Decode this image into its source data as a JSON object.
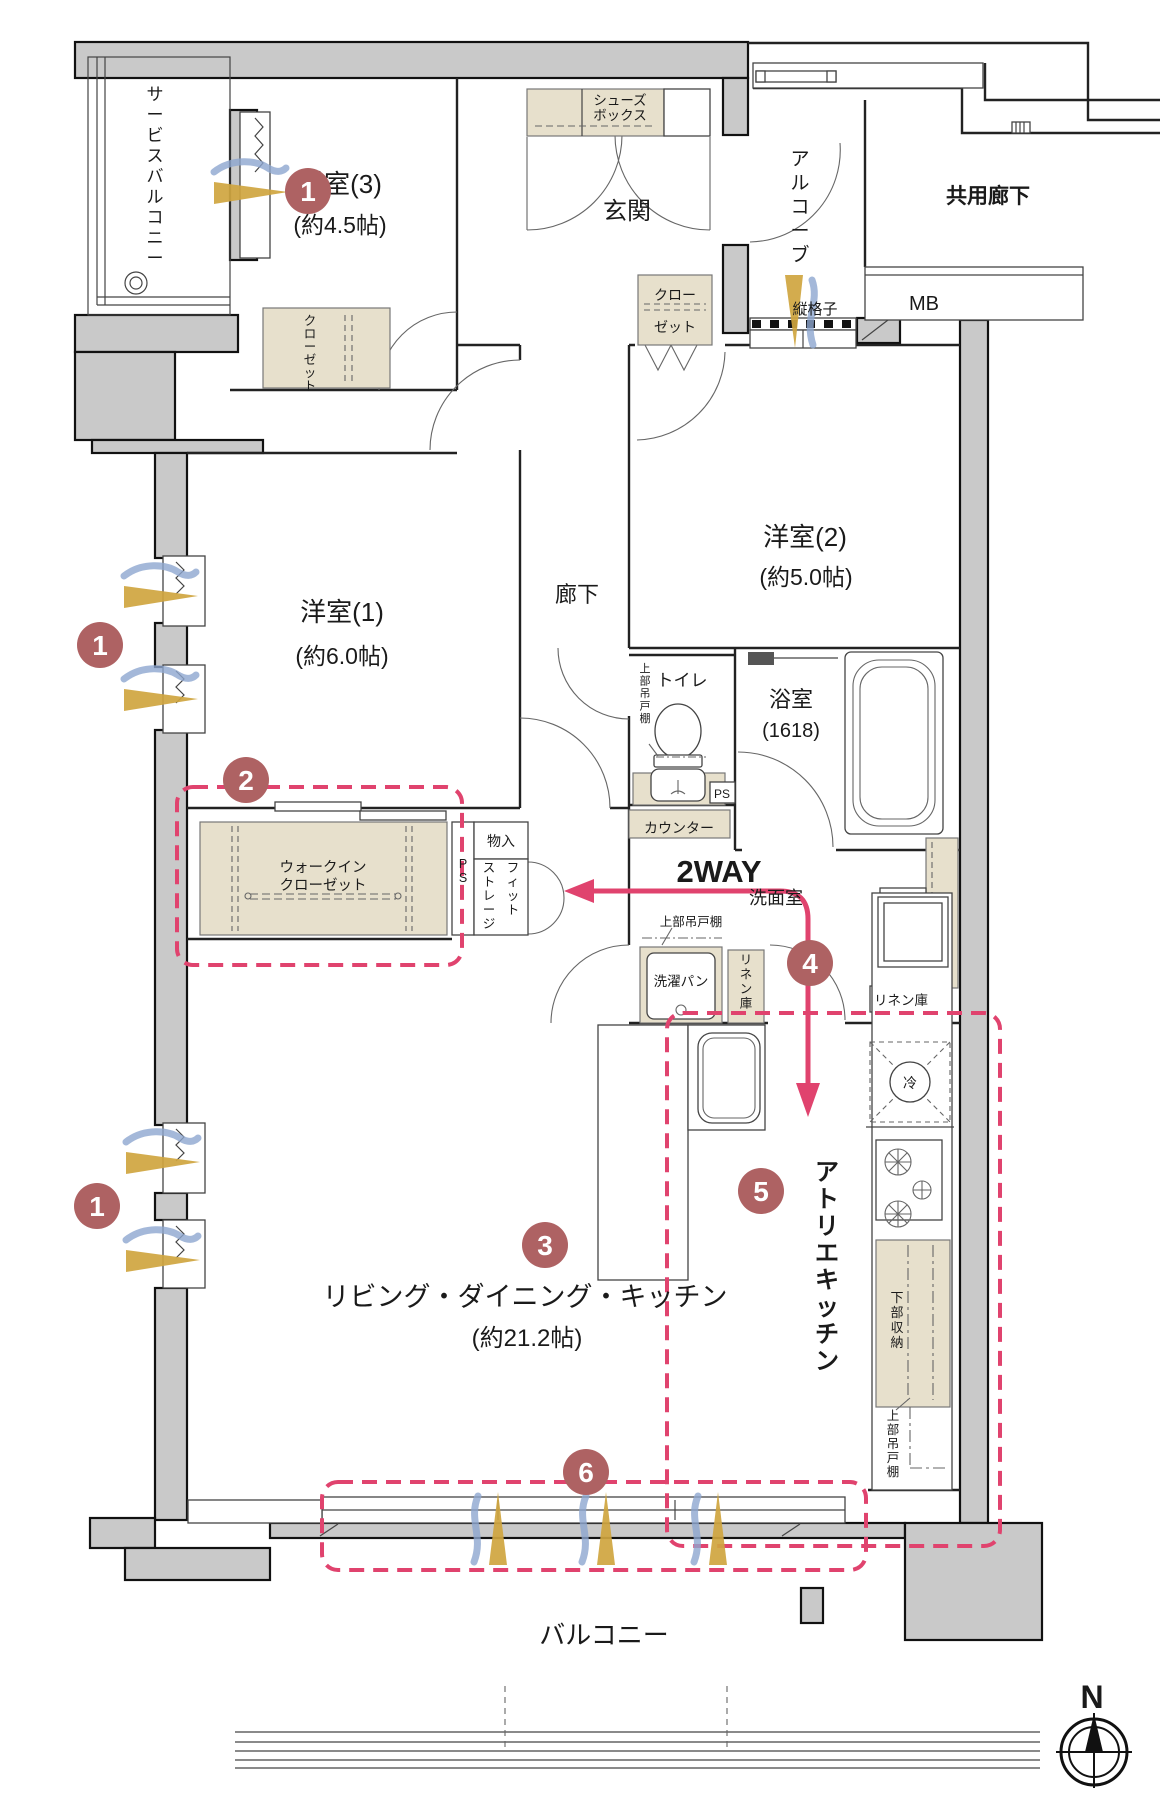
{
  "colors": {
    "accent_pink": "#e0436e",
    "marker_rose": "#ae6263",
    "wall_gray": "#c9c9c9",
    "storage_beige": "#e7e0cc",
    "air_blue": "#8da6cf",
    "air_gold": "#cfa53f"
  },
  "labels": {
    "service_balcony": "サービスバルコニー",
    "yoshitsu3": [
      "洋室(3)",
      "(約4.5帖)"
    ],
    "yoshitsu2": [
      "洋室(2)",
      "(約5.0帖)"
    ],
    "yoshitsu1": [
      "洋室(1)",
      "(約6.0帖)"
    ],
    "genkan": "玄関",
    "shoe_box": [
      "シューズ",
      "ボックス"
    ],
    "alcove": "アルコーブ",
    "tategoshi": "縦格子",
    "kyoyo_roka": "共用廊下",
    "mb": "MB",
    "closet_y3": "クローゼット",
    "closet_genkan": [
      "クロー",
      "ゼット"
    ],
    "roka": "廊下",
    "toilet": "トイレ",
    "toilet_upper_shelf": "上部吊戸棚",
    "bath": [
      "浴室",
      "(1618)"
    ],
    "counter": "カウンター",
    "ps_toilet": "PS",
    "ps_shaft": "PS",
    "wic": [
      "ウォークイン",
      "クローゼット"
    ],
    "monoire": "物入",
    "fit_storage": [
      "フィット",
      "ストレージ"
    ],
    "two_way": "2WAY",
    "senmen": "洗面室",
    "upper_shelf_laundry": "上部吊戸棚",
    "sentaku_pan": "洗濯パン",
    "linen_vertical": "リネン庫",
    "linen_boxed": "リネン庫",
    "rei": "冷",
    "ldk": [
      "リビング・ダイニング・キッチン",
      "(約21.2帖)"
    ],
    "atelier_kitchen": "アトリエキッチン",
    "lower_storage": "下部収納",
    "upper_shelf_kitchen": "上部吊戸棚",
    "balcony": "バルコニー",
    "compass_n": "N"
  },
  "markers": [
    "1",
    "1",
    "1",
    "2",
    "3",
    "4",
    "5",
    "6"
  ]
}
